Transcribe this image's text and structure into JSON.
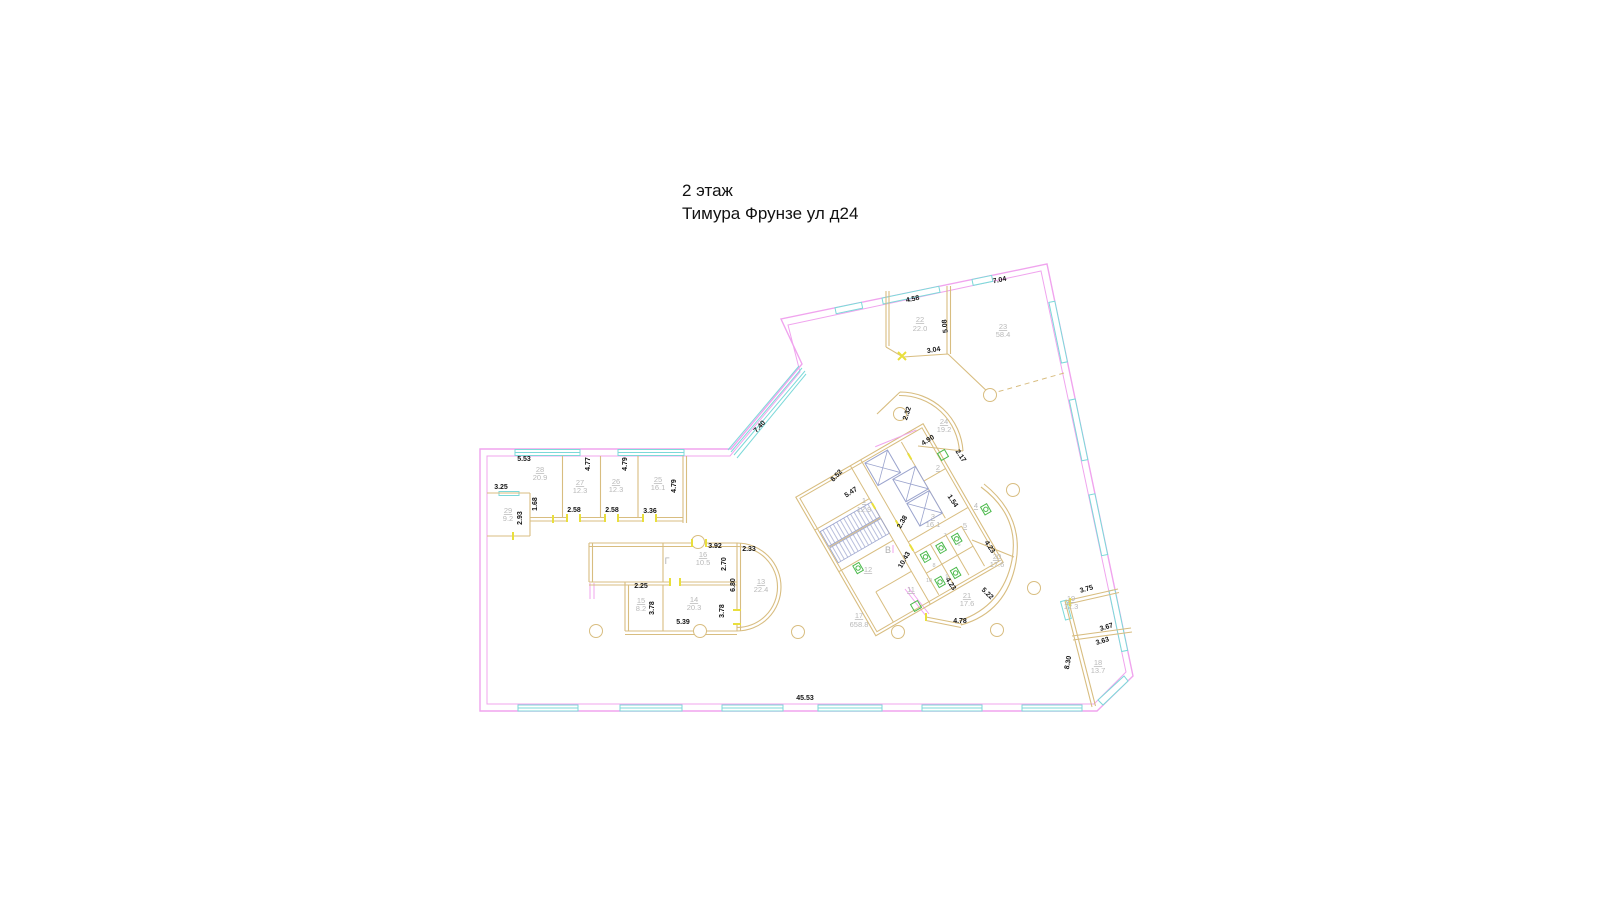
{
  "title": {
    "floor": "2 этаж",
    "address": "Тимура Фрунзе ул д24"
  },
  "plan": {
    "rooms": [
      {
        "num": "1",
        "area": "12.9"
      },
      {
        "num": "2",
        "area": ""
      },
      {
        "num": "3",
        "area": "16.1"
      },
      {
        "num": "4",
        "area": ""
      },
      {
        "num": "5",
        "area": ""
      },
      {
        "num": "6",
        "area": ""
      },
      {
        "num": "7",
        "area": ""
      },
      {
        "num": "8",
        "area": ""
      },
      {
        "num": "9",
        "area": ""
      },
      {
        "num": "10",
        "area": ""
      },
      {
        "num": "11",
        "area": ""
      },
      {
        "num": "12",
        "area": ""
      },
      {
        "num": "13",
        "area": "22.4"
      },
      {
        "num": "14",
        "area": "20.3"
      },
      {
        "num": "15",
        "area": "8.2"
      },
      {
        "num": "16",
        "area": "10.5"
      },
      {
        "num": "17",
        "area": "658.8"
      },
      {
        "num": "18",
        "area": "13.7"
      },
      {
        "num": "19",
        "area": "12.3"
      },
      {
        "num": "20",
        "area": "17.6"
      },
      {
        "num": "21",
        "area": "17.6"
      },
      {
        "num": "22",
        "area": "22.0"
      },
      {
        "num": "23",
        "area": "58.4"
      },
      {
        "num": "24",
        "area": "19.2"
      },
      {
        "num": "25",
        "area": "16.1"
      },
      {
        "num": "26",
        "area": "12.3"
      },
      {
        "num": "27",
        "area": "12.3"
      },
      {
        "num": "28",
        "area": "20.9"
      },
      {
        "num": "29",
        "area": "9.2"
      }
    ],
    "stairs": {
      "v": "В",
      "g": "Г"
    },
    "dims": [
      "5.53",
      "3.25",
      "1.68",
      "2.93",
      "2.58",
      "2.58",
      "3.36",
      "4.77",
      "4.79",
      "4.79",
      "7.40",
      "4.58",
      "5.08",
      "3.04",
      "7.04",
      "2.32",
      "4.90",
      "2.17",
      "8.52",
      "5.47",
      "1.54",
      "2.38",
      "10.43",
      "4.23",
      "4.23",
      "5.22",
      "4.78",
      "3.75",
      "3.67",
      "3.63",
      "8.30",
      "3.92",
      "2.33",
      "2.70",
      "6.80",
      "2.25",
      "3.78",
      "3.78",
      "5.39",
      "45.53"
    ]
  },
  "colors": {
    "exterior_wall": "#f0a4ee",
    "window": "#7cd9d9",
    "interior_wall": "#d8bd80",
    "stair_hatch": "#9aa3cd",
    "fixture": "#4ab94a",
    "room_label": "#b9b9b9",
    "dimension_text": "#141414",
    "door_tick": "#e9df3c"
  }
}
